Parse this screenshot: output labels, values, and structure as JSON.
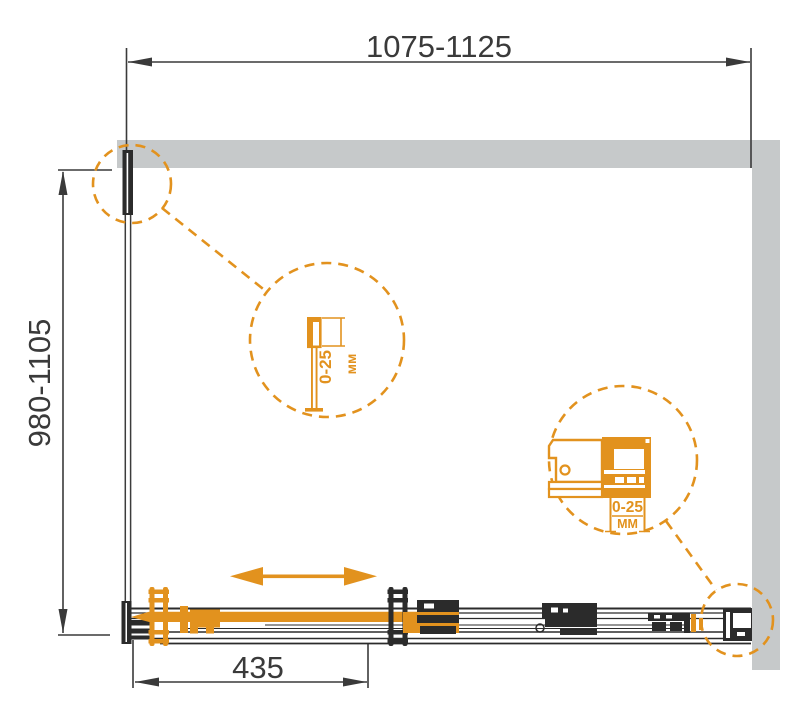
{
  "drawing": {
    "type": "technical-diagram",
    "subject": "Sliding shower door enclosure - plan view with adjustment details",
    "colors": {
      "accent_orange": "#E2921E",
      "wall_gray": "#C6C9CA",
      "ink": "#2B2B2B",
      "dimension_ink": "#3A3A3A",
      "background": "#FFFFFF"
    },
    "dimensions": {
      "width": {
        "label": "1075-1125"
      },
      "height": {
        "label": "980-1105"
      },
      "door": {
        "label": "435"
      }
    },
    "details": {
      "wall_profile_adjustment": {
        "value": "0-25",
        "unit": "мм"
      },
      "roller_adjustment": {
        "value": "0-25",
        "unit": "ММ"
      }
    }
  }
}
